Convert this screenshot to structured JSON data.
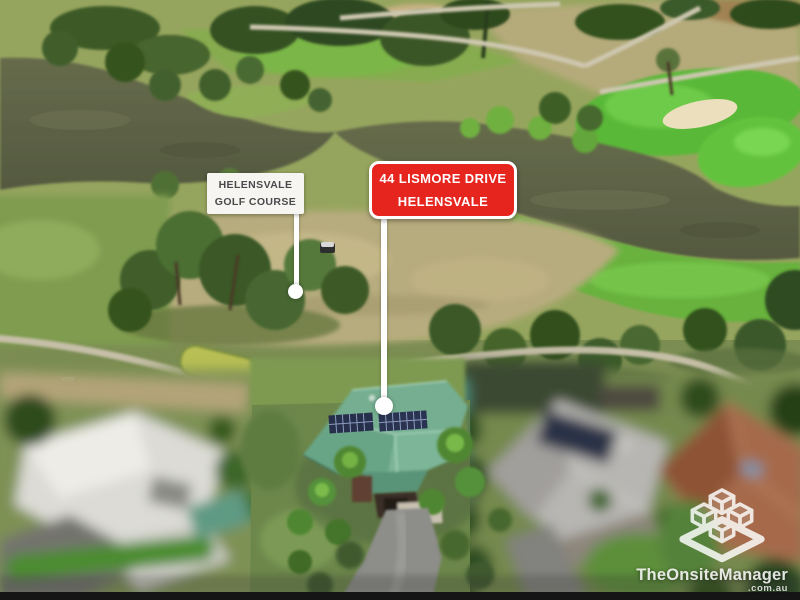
{
  "callouts": {
    "golf_course": {
      "style": "white-label",
      "lines": [
        "HELENSVALE",
        "GOLF COURSE"
      ]
    },
    "property": {
      "style": "red-label",
      "lines": [
        "44 LISMORE DRIVE",
        "HELENSVALE"
      ]
    }
  },
  "watermark": {
    "brand": "TheOnsiteManager",
    "suffix": ".com.au",
    "logo_icon": "stacked-cubes-logo"
  },
  "colors": {
    "callout_red_bg": "#e6251f",
    "callout_red_text": "#ffffff",
    "callout_white_bg": "#f6f5f2",
    "callout_white_text": "#4a4a4c",
    "leader_line": "#ffffff",
    "watermark_text": "#f2f2f0",
    "featured_roof_green": "#6fa98c",
    "golf_green": "#5ab838",
    "water": "#5d6147",
    "dry_grass": "#b7ac7e",
    "sand_bunker": "#ecdfbd"
  }
}
